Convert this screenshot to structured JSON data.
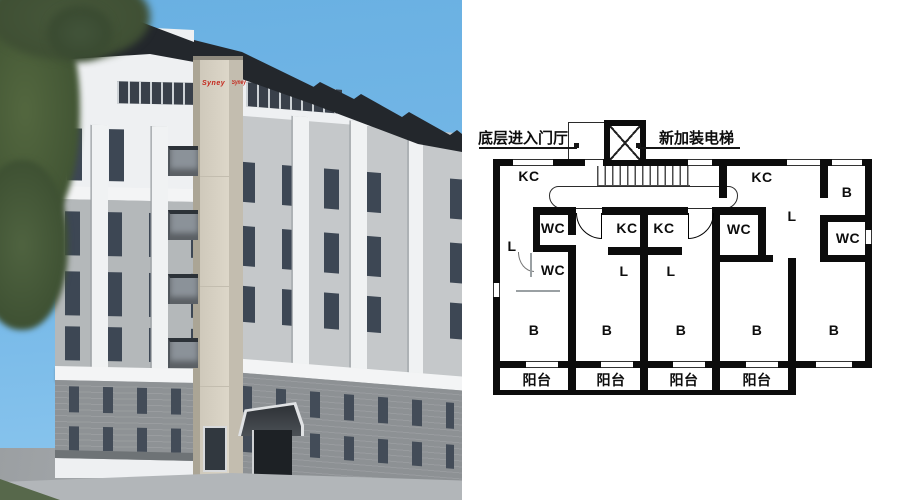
{
  "scene": {
    "description": "Residential building renovation: 3D rendering with newly added external elevator (left) and ground-floor plan (right)",
    "colors": {
      "sky": "#70b5e6",
      "roof": "#23272c",
      "wall_white": "#eef0f2",
      "wall_gray": "#b4b8ba",
      "brick_gray": "#8e9295",
      "tower_beige": "#d9d3c5",
      "logo_red": "#c4261b",
      "plan_wall": "#0c0c0c"
    }
  },
  "render": {
    "elevator_brand_front": "Syney",
    "elevator_brand_side": "Syney"
  },
  "floor_plan": {
    "callouts": {
      "entry_lobby": "底层进入门厅",
      "new_elevator": "新加装电梯"
    },
    "labels": [
      {
        "id": "u1-kc",
        "text": "KC"
      },
      {
        "id": "u1-wc-upper",
        "text": "WC"
      },
      {
        "id": "u1-l",
        "text": "L"
      },
      {
        "id": "u1-wc-lower",
        "text": "WC"
      },
      {
        "id": "u1-b",
        "text": "B"
      },
      {
        "id": "u2-kc",
        "text": "KC"
      },
      {
        "id": "u2-l",
        "text": "L"
      },
      {
        "id": "u2-b",
        "text": "B"
      },
      {
        "id": "u3-kc",
        "text": "KC"
      },
      {
        "id": "u3-l",
        "text": "L"
      },
      {
        "id": "u3-b",
        "text": "B"
      },
      {
        "id": "u4-wc",
        "text": "WC"
      },
      {
        "id": "u4-l",
        "text": "L"
      },
      {
        "id": "u4-b",
        "text": "B"
      },
      {
        "id": "u5-kc",
        "text": "KC"
      },
      {
        "id": "u5-b-top",
        "text": "B"
      },
      {
        "id": "u5-wc",
        "text": "WC"
      },
      {
        "id": "u5-b",
        "text": "B"
      }
    ],
    "balcony_labels": [
      "阳台",
      "阳台",
      "阳台",
      "阳台"
    ]
  }
}
